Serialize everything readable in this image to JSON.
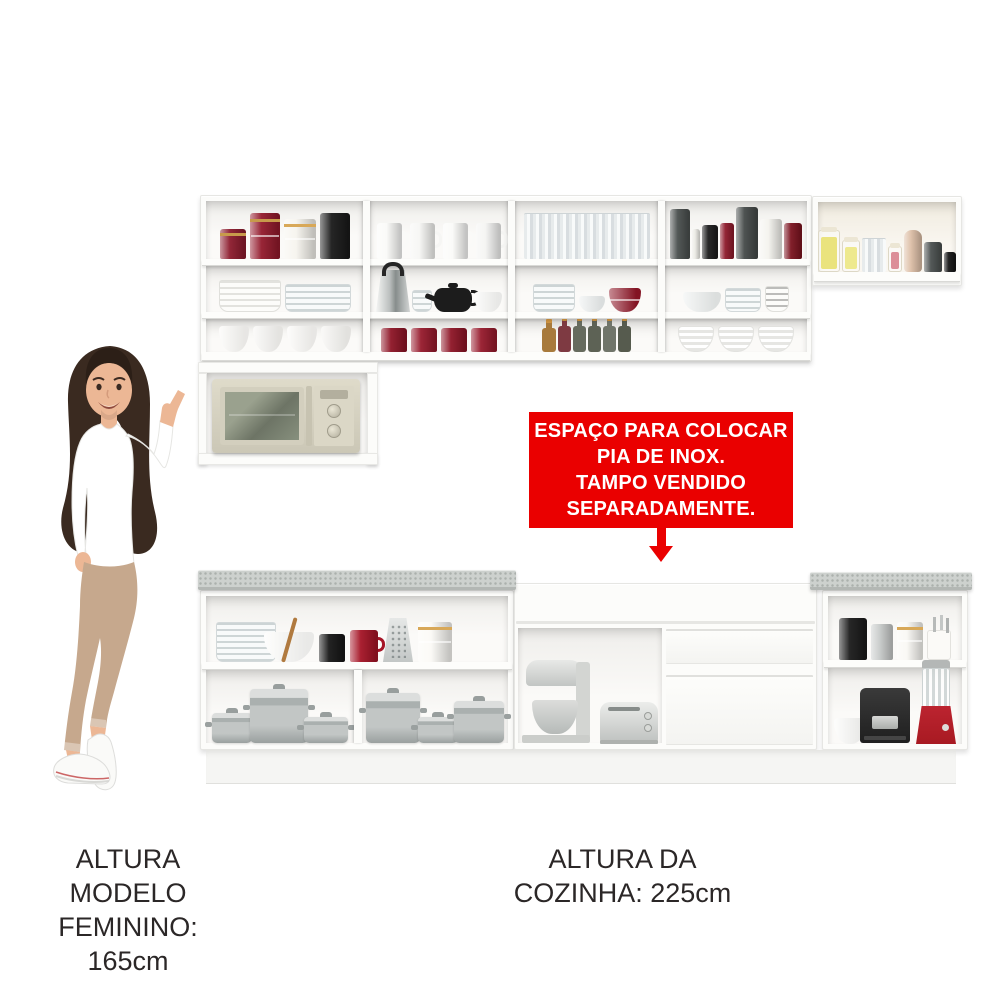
{
  "banner": {
    "lines": [
      "ESPAÇO PARA COLOCAR",
      "PIA DE INOX.",
      "TAMPO VENDIDO",
      "SEPARADAMENTE."
    ]
  },
  "captions": {
    "model_height": {
      "line1": "ALTURA MODELO",
      "line2": "FEMININO: 165cm"
    },
    "kitchen_height": {
      "line1": "ALTURA DA",
      "line2": "COZINHA: 225cm"
    }
  },
  "palette": {
    "cabinet": "#fcfcfa",
    "interiorTop": "#efeeeb",
    "interiorBottom": "#fbfaf8",
    "board": "#fdfdfb",
    "boardEdge": "#d9d9d6",
    "counter": "#cdd1ce",
    "counterEdge": "#b3b7b4",
    "kick": "#f5f5f3",
    "bannerBg": "#ea0000",
    "bannerFg": "#ffffff",
    "caption": "#2b2727",
    "maroon": "#8e1526",
    "steel": "#c9cccb",
    "applianceDark": "#282828",
    "blenderRed": "#a81a22",
    "hair": "#3a2a20",
    "hairDark": "#2c1f17",
    "skin": "#ecb795",
    "topWhite": "#ffffff",
    "pants": "#c6a88d",
    "shoe": "#fafaf8"
  },
  "items": {
    "u11": [
      {
        "n": "red-canister",
        "t": "can",
        "c": "#8c1b2d",
        "b": "#c79a4b",
        "w": 26,
        "h": 30
      },
      {
        "n": "red-canister-stack",
        "t": "can",
        "c": "#931a2c",
        "b": "#c79a4b",
        "split": 1,
        "w": 30,
        "h": 46
      },
      {
        "n": "white-canister-stack",
        "t": "can",
        "c": "#f6f4ee",
        "b": "#d8a858",
        "split": 1,
        "w": 32,
        "h": 40
      },
      {
        "n": "black-canister",
        "t": "can",
        "c": "#1a1a1a",
        "w": 30,
        "h": 46
      }
    ],
    "u12": [
      {
        "n": "white-mug",
        "t": "mug",
        "c": "#fafaf8",
        "w": 25,
        "h": 36
      },
      {
        "n": "white-mug",
        "t": "mug",
        "c": "#f6f6f4",
        "w": 25,
        "h": 36
      },
      {
        "n": "white-mug",
        "t": "mug",
        "c": "#fafaf8",
        "w": 25,
        "h": 36
      },
      {
        "n": "white-mug",
        "t": "mug",
        "c": "#f4f4f2",
        "w": 25,
        "h": 36
      }
    ],
    "u13": [
      {
        "n": "drinking-glasses",
        "t": "glasses",
        "w": 126,
        "h": 46
      }
    ],
    "u14": [
      {
        "n": "gray-canister",
        "t": "can",
        "c": "#4a4f4e",
        "w": 20,
        "h": 50
      },
      {
        "n": "white-jar",
        "t": "can",
        "c": "#ecebe5",
        "w": 8,
        "h": 30
      },
      {
        "n": "black-canister",
        "t": "can",
        "c": "#1d1d1d",
        "w": 16,
        "h": 34
      },
      {
        "n": "red-canister",
        "t": "can",
        "c": "#8e1a2b",
        "w": 14,
        "h": 36
      },
      {
        "n": "gray-canister",
        "t": "can",
        "c": "#454a49",
        "w": 22,
        "h": 52
      },
      {
        "n": "white-canister",
        "t": "can",
        "c": "#f4f3ee",
        "w": 22,
        "h": 40
      },
      {
        "n": "dark-red-box",
        "t": "can",
        "c": "#7c1420",
        "w": 18,
        "h": 36
      }
    ],
    "u21": [
      {
        "n": "white-plate-stack",
        "t": "plates",
        "w": 62,
        "h": 32
      },
      {
        "n": "glass-plate-stack",
        "t": "gplates",
        "w": 66,
        "h": 28
      }
    ],
    "u22": [
      {
        "n": "kettle",
        "t": "kettle",
        "w": 34,
        "h": 42
      },
      {
        "n": "glass-cup-stack",
        "t": "gplates",
        "w": 20,
        "h": 22
      },
      {
        "n": "black-teapot",
        "t": "teapot",
        "c": "#1c1c1c",
        "w": 38,
        "h": 24
      },
      {
        "n": "white-bowl",
        "t": "bowl",
        "c": "#fbfbf9",
        "w": 28,
        "h": 20
      }
    ],
    "u23": [
      {
        "n": "glass-plates",
        "t": "gplates",
        "w": 42,
        "h": 28
      },
      {
        "n": "glass-bowl",
        "t": "bowl",
        "c": "#edf0f0",
        "w": 26,
        "h": 16
      },
      {
        "n": "red-bowl-stack",
        "t": "bowl",
        "c": "#8e1526",
        "split": 1,
        "w": 32,
        "h": 24
      }
    ],
    "u24": [
      {
        "n": "glass-bowl",
        "t": "bowl",
        "c": "#eef1f0",
        "w": 38,
        "h": 20
      },
      {
        "n": "glass-containers",
        "t": "gplates",
        "w": 36,
        "h": 24
      },
      {
        "n": "gray-plate-stack",
        "t": "plates",
        "c": "#bcbcba",
        "w": 24,
        "h": 26
      }
    ],
    "u31": [
      {
        "n": "white-bowl",
        "t": "bowl",
        "c": "#fbfaf7",
        "w": 30,
        "h": 26
      },
      {
        "n": "white-bowl",
        "t": "bowl",
        "c": "#f7f6f3",
        "w": 30,
        "h": 26
      },
      {
        "n": "white-bowl",
        "t": "bowl",
        "c": "#fbfaf7",
        "w": 30,
        "h": 26
      },
      {
        "n": "white-bowl",
        "t": "bowl",
        "c": "#f5f4f1",
        "w": 30,
        "h": 26
      }
    ],
    "u32": [
      {
        "n": "red-canister",
        "t": "can",
        "c": "#8e1526",
        "w": 26,
        "h": 24
      },
      {
        "n": "red-canister",
        "t": "can",
        "c": "#971a2c",
        "w": 26,
        "h": 24
      },
      {
        "n": "red-canister",
        "t": "can",
        "c": "#8e1526",
        "w": 26,
        "h": 24
      },
      {
        "n": "red-canister",
        "t": "can",
        "c": "#971a2c",
        "w": 26,
        "h": 24
      }
    ],
    "u33": [
      {
        "n": "amber-bottle",
        "t": "bottle",
        "c": "#a87a3c",
        "w": 14,
        "h": 24
      },
      {
        "n": "red-bottle",
        "t": "bottle",
        "c": "#7e3a42",
        "w": 13,
        "h": 26
      },
      {
        "n": "green-bottle",
        "t": "bottle",
        "c": "#666b5e",
        "w": 13,
        "h": 26
      },
      {
        "n": "green-bottle",
        "t": "bottle",
        "c": "#5d6255",
        "w": 13,
        "h": 26
      },
      {
        "n": "green-bottle",
        "t": "bottle",
        "c": "#70756a",
        "w": 13,
        "h": 26
      },
      {
        "n": "green-bottle",
        "t": "bottle",
        "c": "#565b4e",
        "w": 13,
        "h": 26
      }
    ],
    "u34": [
      {
        "n": "white-swirl-bowl",
        "t": "swirl",
        "w": 36,
        "h": 26
      },
      {
        "n": "white-swirl-bowl",
        "t": "swirl",
        "w": 36,
        "h": 26
      },
      {
        "n": "white-swirl-bowl",
        "t": "swirl",
        "w": 36,
        "h": 26
      }
    ],
    "side": [
      {
        "n": "pasta-jar",
        "t": "jar",
        "c": "#e8e172",
        "f": 80,
        "w": 22,
        "h": 42
      },
      {
        "n": "pasta-jar",
        "t": "jar",
        "c": "#ede784",
        "f": 75,
        "w": 18,
        "h": 32
      },
      {
        "n": "glass-cups",
        "t": "glasses",
        "w": 24,
        "h": 34
      },
      {
        "n": "pink-jar",
        "t": "jar",
        "c": "#d9848f",
        "f": 70,
        "w": 14,
        "h": 26
      },
      {
        "n": "candle",
        "t": "candle",
        "c": "#ddbfa7",
        "w": 18,
        "h": 42
      },
      {
        "n": "gray-canister",
        "t": "can",
        "c": "#4b504f",
        "w": 18,
        "h": 30
      },
      {
        "n": "black-cup",
        "t": "can",
        "c": "#161616",
        "w": 12,
        "h": 20
      }
    ],
    "llShelf": [
      {
        "n": "glass-bowls-and-plates",
        "t": "gplates",
        "w": 60,
        "h": 40
      },
      {
        "n": "wooden-spoon",
        "t": "stick",
        "c": "#b07a3f",
        "w": 4,
        "h": 46,
        "mr": -26
      },
      {
        "n": "mixing-bowl",
        "t": "bowl",
        "c": "#fdfdfb",
        "w": 50,
        "h": 30
      },
      {
        "n": "black-mug",
        "t": "can",
        "c": "#171717",
        "w": 26,
        "h": 28
      },
      {
        "n": "red-mug",
        "t": "mug",
        "c": "#a51426",
        "w": 28,
        "h": 32
      },
      {
        "n": "grater",
        "t": "grater",
        "w": 30,
        "h": 44
      },
      {
        "n": "white-canister-stack",
        "t": "can",
        "c": "#fbfaf6",
        "split": 1,
        "b": "#d8a858",
        "w": 34,
        "h": 40
      }
    ],
    "llPots1": [
      {
        "n": "saucepan",
        "t": "pot",
        "w": 40,
        "h": 30
      },
      {
        "n": "stockpot",
        "t": "pot",
        "w": 58,
        "h": 54,
        "ml": -6
      },
      {
        "n": "pan",
        "t": "pot",
        "w": 44,
        "h": 26,
        "ml": -8
      }
    ],
    "llPots2": [
      {
        "n": "stockpot",
        "t": "pot",
        "w": 54,
        "h": 50
      },
      {
        "n": "saucepan",
        "t": "pot",
        "w": 40,
        "h": 26,
        "ml": -6
      },
      {
        "n": "casserole",
        "t": "pot",
        "w": 50,
        "h": 42,
        "ml": -8
      }
    ],
    "lrShelf": [
      {
        "n": "black-canister",
        "t": "can",
        "c": "#1b1b1b",
        "w": 28,
        "h": 42
      },
      {
        "n": "silver-canister",
        "t": "can",
        "c": "#c9cccb",
        "w": 22,
        "h": 36
      },
      {
        "n": "white-canister-stack",
        "t": "can",
        "c": "#f9f8f4",
        "split": 1,
        "b": "#d8a858",
        "w": 26,
        "h": 38
      },
      {
        "n": "utensil-holder",
        "t": "utensil",
        "w": 24,
        "h": 30
      }
    ],
    "lrLower": [
      {
        "n": "white-bowl",
        "t": "bowl",
        "c": "#fcfcfa",
        "w": 32,
        "h": 26
      }
    ]
  }
}
